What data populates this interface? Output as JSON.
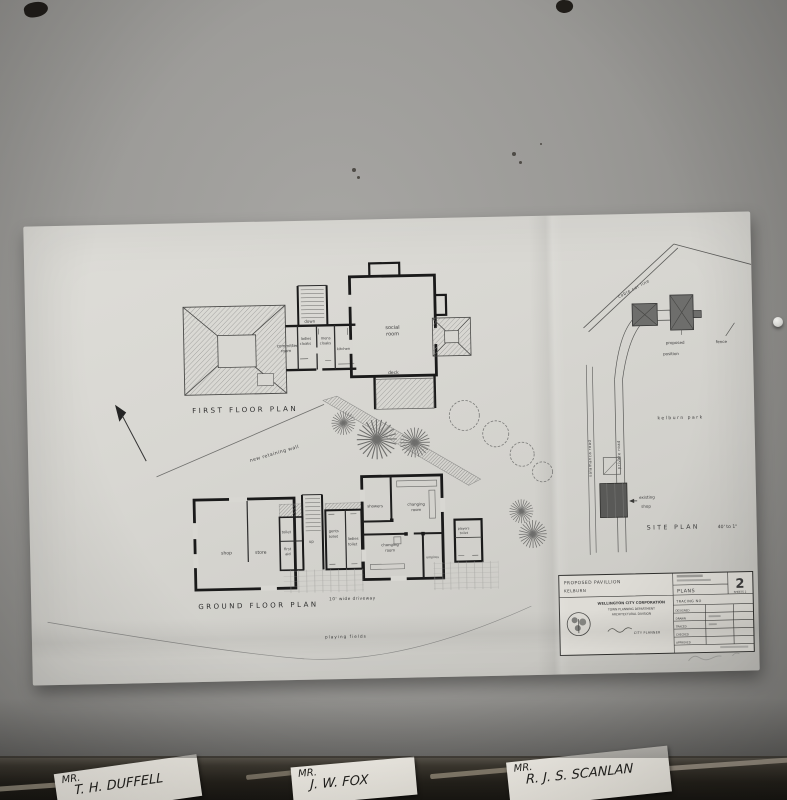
{
  "drawing": {
    "first_floor": {
      "title": "FIRST FLOOR PLAN",
      "labels": {
        "committee_l1": "committee",
        "committee_l2": "room",
        "down": "down",
        "ladies_l1": "ladies",
        "ladies_l2": "cloaks",
        "mens_l1": "mens",
        "mens_l2": "cloaks",
        "kitchen": "kitchen",
        "social_l1": "social",
        "social_l2": "room",
        "deck": "deck"
      }
    },
    "ground_floor": {
      "title": "GROUND FLOOR PLAN",
      "labels": {
        "shop": "shop",
        "store": "store",
        "toilet": "toilet",
        "first_aid_l1": "first",
        "first_aid_l2": "aid",
        "up": "up",
        "gents_l1": "gents",
        "gents_l2": "toilet",
        "ladies_l1": "ladies",
        "ladies_l2": "toilet",
        "showers": "showers",
        "changing_top_l1": "changing",
        "changing_top_l2": "room",
        "changing_bot_l1": "changing",
        "changing_bot_l2": "room",
        "umpires": "umpires",
        "players_l1": "players",
        "players_l2": "toilet"
      },
      "annotations": {
        "retaining_wall": "new retaining wall",
        "driveway": "10' wide  driveway",
        "playing_fields": "playing  fields"
      }
    },
    "site_plan": {
      "title": "SITE  PLAN",
      "scale": "40' to 1\"",
      "labels": {
        "cable_car": "cable car line",
        "kelburn_park": "kelburn  park",
        "salamanca_road": "salamanca  road",
        "private_road": "private  road",
        "proposed_l1": "proposed",
        "proposed_l2": "position",
        "fence": "fence",
        "existing_l1": "existing",
        "existing_l2": "shop"
      }
    },
    "title_block": {
      "project_l1": "PROPOSED   PAVILLION",
      "project_l2": "KELBURN",
      "org_l1": "WELLINGTON CITY CORPORATION",
      "org_l2": "TOWN PLANNING DEPARTMENT",
      "org_l3": "ARCHITECTURAL DIVISION",
      "signature": "CITY PLANNER",
      "content": "PLANS",
      "sheet_number": "2",
      "sheet_of": "SHEETS 2",
      "tracing": "TRACING NO",
      "rows": [
        "DESIGNED",
        "DRAWN",
        "TRACED",
        "CHECKED",
        "APPROVED"
      ]
    }
  },
  "name_cards": [
    {
      "prefix": "MR.",
      "name": "T. H. DUFFELL"
    },
    {
      "prefix": "MR.",
      "name": "J. W. FOX"
    },
    {
      "prefix": "MR.",
      "name": "R. J. S. SCANLAN"
    }
  ]
}
